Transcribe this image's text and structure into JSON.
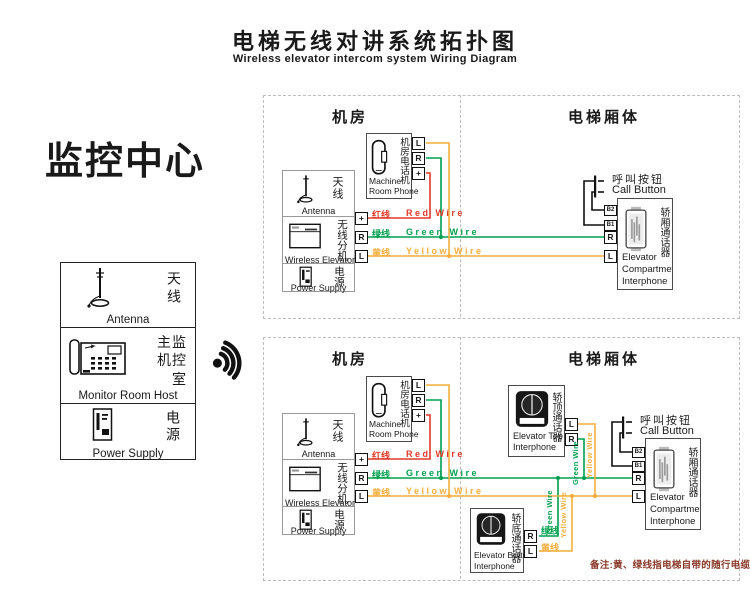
{
  "title": {
    "zh": "电梯无线对讲系统拓扑图",
    "en": "Wireless elevator intercom system Wiring Diagram"
  },
  "monitor_center": {
    "heading": "监控中心",
    "antenna": {
      "zh": "天线",
      "en": "Antenna"
    },
    "host": {
      "zh": "主监\n机控\n室",
      "en": "Monitor Room Host"
    },
    "power": {
      "zh": "电源",
      "en": "Power Supply"
    }
  },
  "sections": {
    "machine_room": "机房",
    "elevator_car": "电梯厢体"
  },
  "devices": {
    "machine_room_phone": {
      "zh": "机房电话机",
      "en": "Machine\nRoom Phone"
    },
    "antenna": {
      "zh": "天线",
      "en": "Antenna"
    },
    "wireless_extension": {
      "zh": "无线分机",
      "en": "Wireless Elevator"
    },
    "power": {
      "zh": "电源",
      "en": "Power Supply"
    },
    "call_button": {
      "zh": "呼叫按钮",
      "en": "Call Button"
    },
    "compartment_interphone": {
      "zh": "轿厢通话器",
      "en": "Elevator\nCompartmet\nInterphone"
    },
    "top_interphone": {
      "zh": "轿顶通话器",
      "en": "Elevator Top\nInterphone"
    },
    "bottom_interphone": {
      "zh": "轿底通话器",
      "en": "Elevator Bottom\nInterphone"
    }
  },
  "terminals": {
    "plus": "+",
    "r": "R",
    "l": "L",
    "b1": "B1",
    "b2": "B2"
  },
  "wires": {
    "red": {
      "zh": "红线",
      "en": "Red Wire",
      "color": "#e03a28"
    },
    "green": {
      "zh": "绿线",
      "en": "Green Wire",
      "color": "#00a050"
    },
    "yellow": {
      "zh": "黄线",
      "en": "Yellow Wire",
      "color": "#f6ae3d"
    }
  },
  "note": "备注:黄、绿线指电梯自带的随行电缆"
}
